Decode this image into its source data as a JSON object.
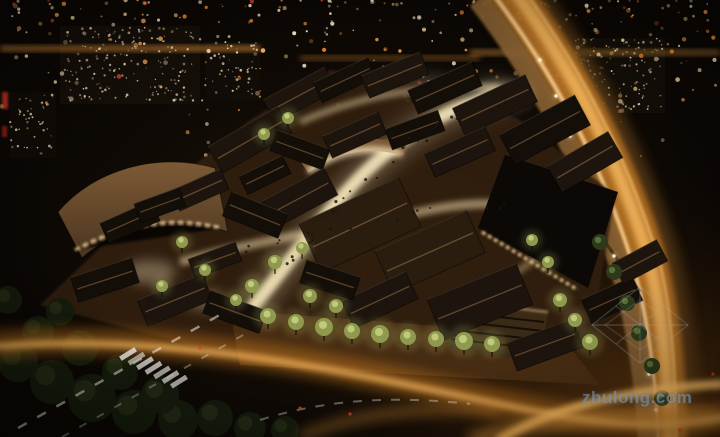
{
  "image": {
    "description": "Night aerial rendering of a traditional Chinese-style commercial district: dark tiled roofs, brightly lit winding pedestrian streets with crowds and trees, a curved modern building at left, a sweeping highway with amber light trails at right, and a glittering city skyline behind"
  },
  "watermark": {
    "text": "zhulong.com"
  },
  "palette": {
    "background_dark": "#0b0704",
    "city_glow": "#ffd98c",
    "amber": "#ffb25e",
    "deep_orange": "#d9832a",
    "trail_core": "#f2b45c",
    "street_glow": "#f7e7bd",
    "roof_dark": "#17100a",
    "roof_tan": "#6e4f30",
    "tree_lit": "#8f9a4e",
    "tree_lit_hi": "#cdd688",
    "tree_dark": "#151c0d",
    "tree_green": "#2c3a1b",
    "sidewalk_tan": "#8a6436",
    "red_sign": "#c03024",
    "lane_white": "#f0efe8",
    "watermark_blue": "#809bb6"
  }
}
